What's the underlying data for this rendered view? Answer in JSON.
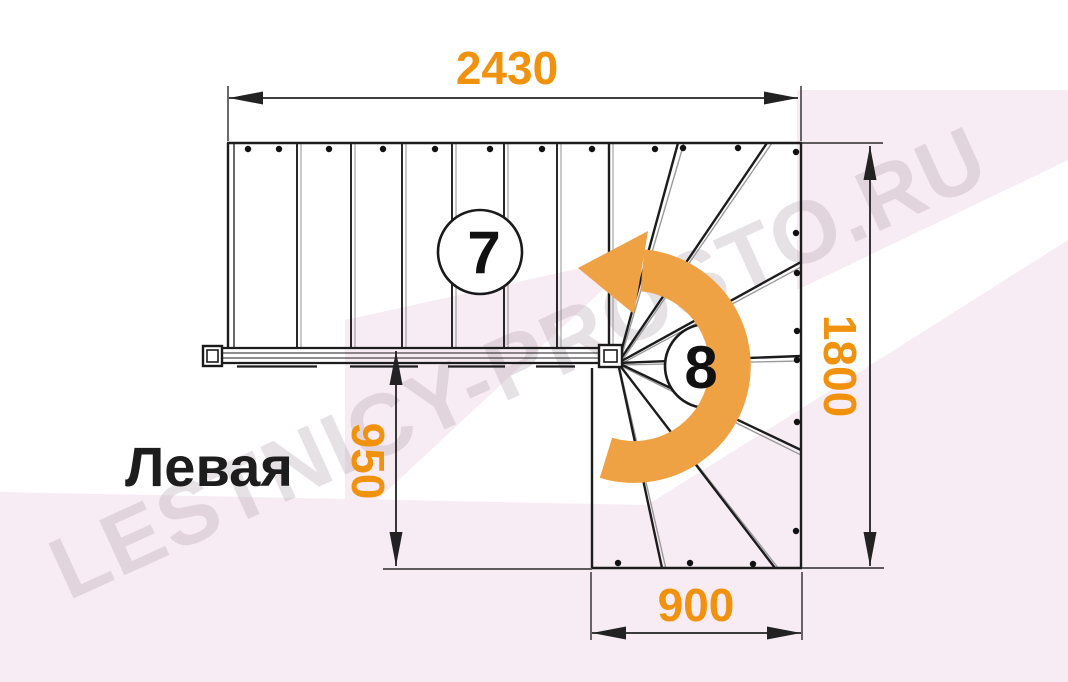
{
  "watermark": {
    "text": "LESTNICY-PROSTO.RU"
  },
  "title": {
    "text": "Левая"
  },
  "plan": {
    "type": "staircase-plan-with-winder",
    "turn_direction_label": "Левая",
    "flight_steps_label": "7",
    "winder_steps_label": "8"
  },
  "dims": {
    "top": {
      "value": "2430",
      "orientation": "horizontal"
    },
    "right": {
      "value": "1800",
      "orientation": "vertical"
    },
    "inner": {
      "value": "950",
      "orientation": "vertical"
    },
    "bottom": {
      "value": "900",
      "orientation": "horizontal"
    }
  },
  "colors": {
    "dimension_text": "#f0920e",
    "turn_arrow": "#efa243",
    "line": "#1d1d1d",
    "background_tint": "#f8ecf4",
    "watermark": "#b2a3b1"
  }
}
